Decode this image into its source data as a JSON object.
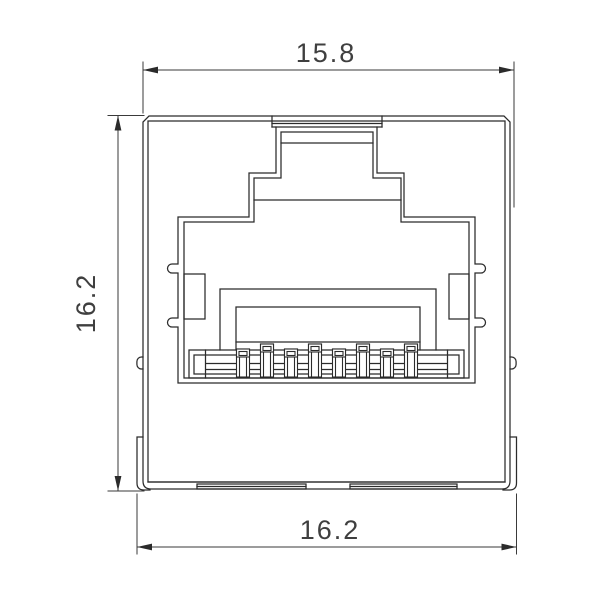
{
  "meta": {
    "drawing_type": "technical dimension drawing",
    "subject": "RJ45 modular jack, front view"
  },
  "dimensions": {
    "top_width": "15.8",
    "side_height": "16.2",
    "bottom_width": "16.2"
  },
  "diagram": {
    "pin_count": 8,
    "background_color": "#ffffff",
    "line_color": "#2b2b2b",
    "dimension_color": "#3a3a3a",
    "text_color": "#3f3f3f"
  }
}
